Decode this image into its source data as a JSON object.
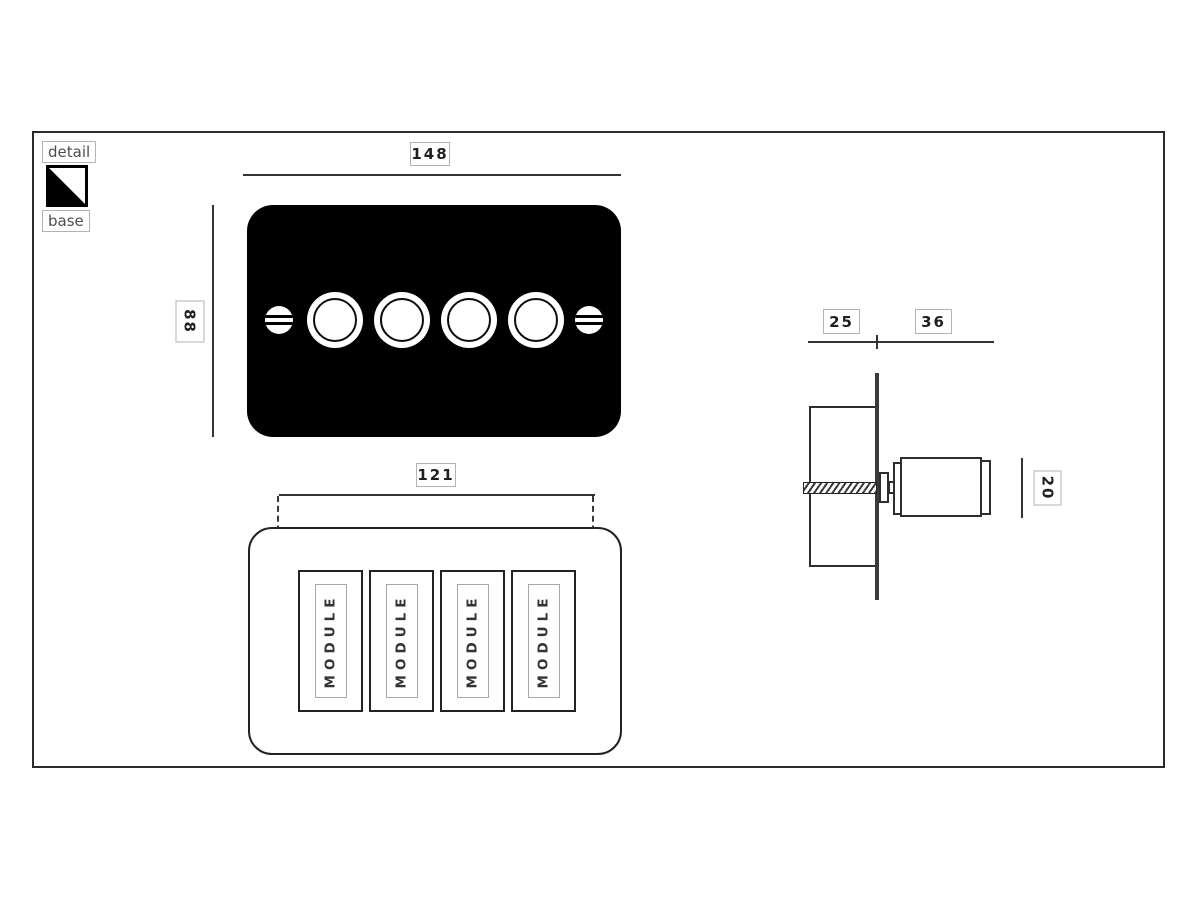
{
  "legend": {
    "detail_label": "detail",
    "base_label": "base",
    "swatch": {
      "detail_color": "#000000",
      "base_color": "#ffffff"
    }
  },
  "plan_view": {
    "width_mm": "148",
    "height_mm": "88",
    "plate_color": "#000000",
    "knob_count": 4
  },
  "back_view": {
    "fixing_centres_mm": "121",
    "modules": [
      "MODULE",
      "MODULE",
      "MODULE",
      "MODULE"
    ]
  },
  "side_view": {
    "recess_depth_mm": "25",
    "projection_mm": "36",
    "knob_height_mm": "20"
  }
}
